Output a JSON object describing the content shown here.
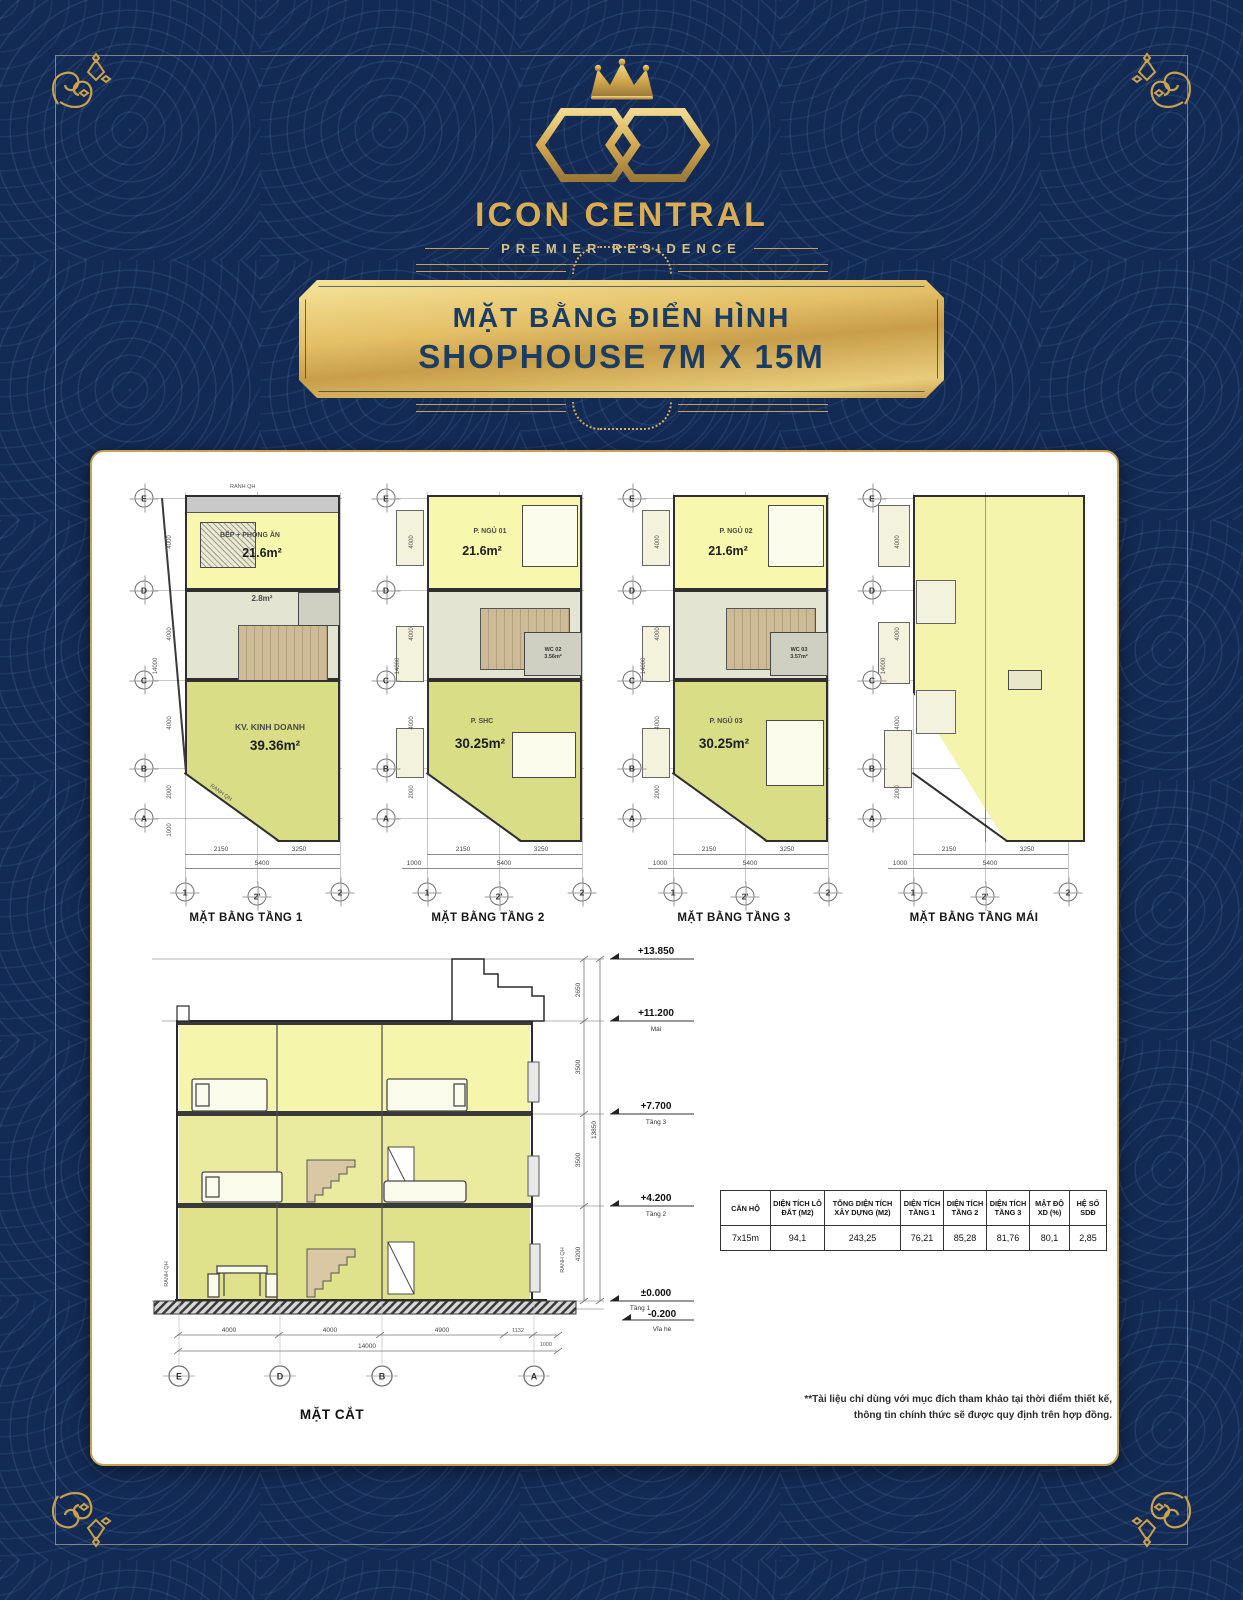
{
  "logo": {
    "brand": "ICON CENTRAL",
    "tagline": "PREMIER RESIDENCE"
  },
  "banner": {
    "line1": "MẶT BẰNG ĐIỂN HÌNH",
    "line2": "SHOPHOUSE 7M X 15M"
  },
  "shared": {
    "rows": [
      "E",
      "D",
      "C",
      "B",
      "A"
    ],
    "cols": [
      "1",
      "2'",
      "2"
    ],
    "side_dims": [
      "4000",
      "4000",
      "4000",
      "2000",
      "1000"
    ],
    "side_total": "14000"
  },
  "plans": [
    {
      "caption": "MẶT BẰNG TẦNG 1",
      "boundary_label_top": "RANH QH",
      "boundary_label_diag": "RANH QH",
      "top_name": "BẾP + PHÒNG ĂN",
      "top_area": "21.6m²",
      "wc_name": "",
      "wc_area": "2.8m²",
      "bottom_name": "KV. KINH DOANH",
      "bottom_area": "39.36m²",
      "dim_lead": "",
      "dim_seg1": "2150",
      "dim_seg2": "3250",
      "dim_total": "5400"
    },
    {
      "caption": "MẶT BẰNG TẦNG 2",
      "top_name": "P. NGỦ 01",
      "top_area": "21.6m²",
      "wc_name": "WC 02",
      "wc_area": "3.56m²",
      "bottom_name": "P. SHC",
      "bottom_area": "30.25m²",
      "dim_lead": "1000",
      "dim_seg1": "2150",
      "dim_seg2": "3250",
      "dim_total": "5400"
    },
    {
      "caption": "MẶT BẰNG TẦNG 3",
      "top_name": "P. NGỦ 02",
      "top_area": "21.6m²",
      "wc_name": "WC 03",
      "wc_area": "3.57m²",
      "bottom_name": "P. NGỦ 03",
      "bottom_area": "30.25m²",
      "dim_lead": "1000",
      "dim_seg1": "2150",
      "dim_seg2": "3250",
      "dim_total": "5400"
    },
    {
      "caption": "MẶT BẰNG TẦNG MÁI",
      "top_name": "",
      "top_area": "",
      "wc_name": "",
      "wc_area": "",
      "bottom_name": "",
      "bottom_area": "",
      "dim_lead": "1000",
      "dim_seg1": "2150",
      "dim_seg2": "3250",
      "dim_total": "5400"
    }
  ],
  "section": {
    "caption": "MẶT CẮT",
    "levels": [
      {
        "value": "+13.850",
        "label": ""
      },
      {
        "value": "+11.200",
        "label": "Mái"
      },
      {
        "value": "+7.700",
        "label": "Tầng 3"
      },
      {
        "value": "+4.200",
        "label": "Tầng 2"
      },
      {
        "value": "±0.000",
        "label": "Tầng 1"
      },
      {
        "value": "-0.200",
        "label": "Vỉa hè"
      }
    ],
    "bottom_dims": [
      "4000",
      "4000",
      "4900",
      "1132",
      "1000"
    ],
    "bottom_total": "14000",
    "side_dims": [
      "2650",
      "3500",
      "3500",
      "4200"
    ],
    "side_total": "13850",
    "grid": [
      "E",
      "D",
      "B",
      "A"
    ],
    "boundary_left": "RANH QH",
    "boundary_right": "RANH QH"
  },
  "table": {
    "headers": [
      "CĂN HỘ",
      "DIỆN TÍCH LÔ ĐẤT (M2)",
      "TỔNG DIỆN TÍCH XÂY DỰNG (M2)",
      "DIỆN TÍCH TẦNG 1",
      "DIỆN TÍCH TẦNG 2",
      "DIỆN TÍCH TẦNG 3",
      "MẬT ĐỘ XD (%)",
      "HỆ SỐ SDĐ"
    ],
    "row": [
      "7x15m",
      "94,1",
      "243,25",
      "76,21",
      "85,28",
      "81,76",
      "80,1",
      "2,85"
    ]
  },
  "disclaimer": {
    "line1": "**Tài liệu chỉ dùng với mục đích tham khảo tại thời điểm thiết kế,",
    "line2": "thông tin chính thức sẽ được quy định trên hợp đồng."
  },
  "colors": {
    "background_navy": "#132a54",
    "gold": "#c9a24f",
    "plaque_text_navy": "#1c3d63",
    "room_yellow": "#f8f7ae",
    "room_green": "#d9dd86",
    "hall_grey": "#e3e4d2",
    "stairs_tan": "#cdbb98"
  },
  "icons": {
    "crown-icon": "gold crown above monogram",
    "monogram-icon": "interlocked double hexagon CO monogram",
    "corner-flourish-icon": "gold floral scroll at frame corners",
    "stairs-icon": "hatched stair block",
    "bed-icon": "bed outline",
    "dining-table-icon": "hatched dining table",
    "sofa-icon": "sofa outline",
    "skylight-hatch-icon": "hatched roof skylight",
    "elevation-marker-icon": "level flag triangle"
  }
}
